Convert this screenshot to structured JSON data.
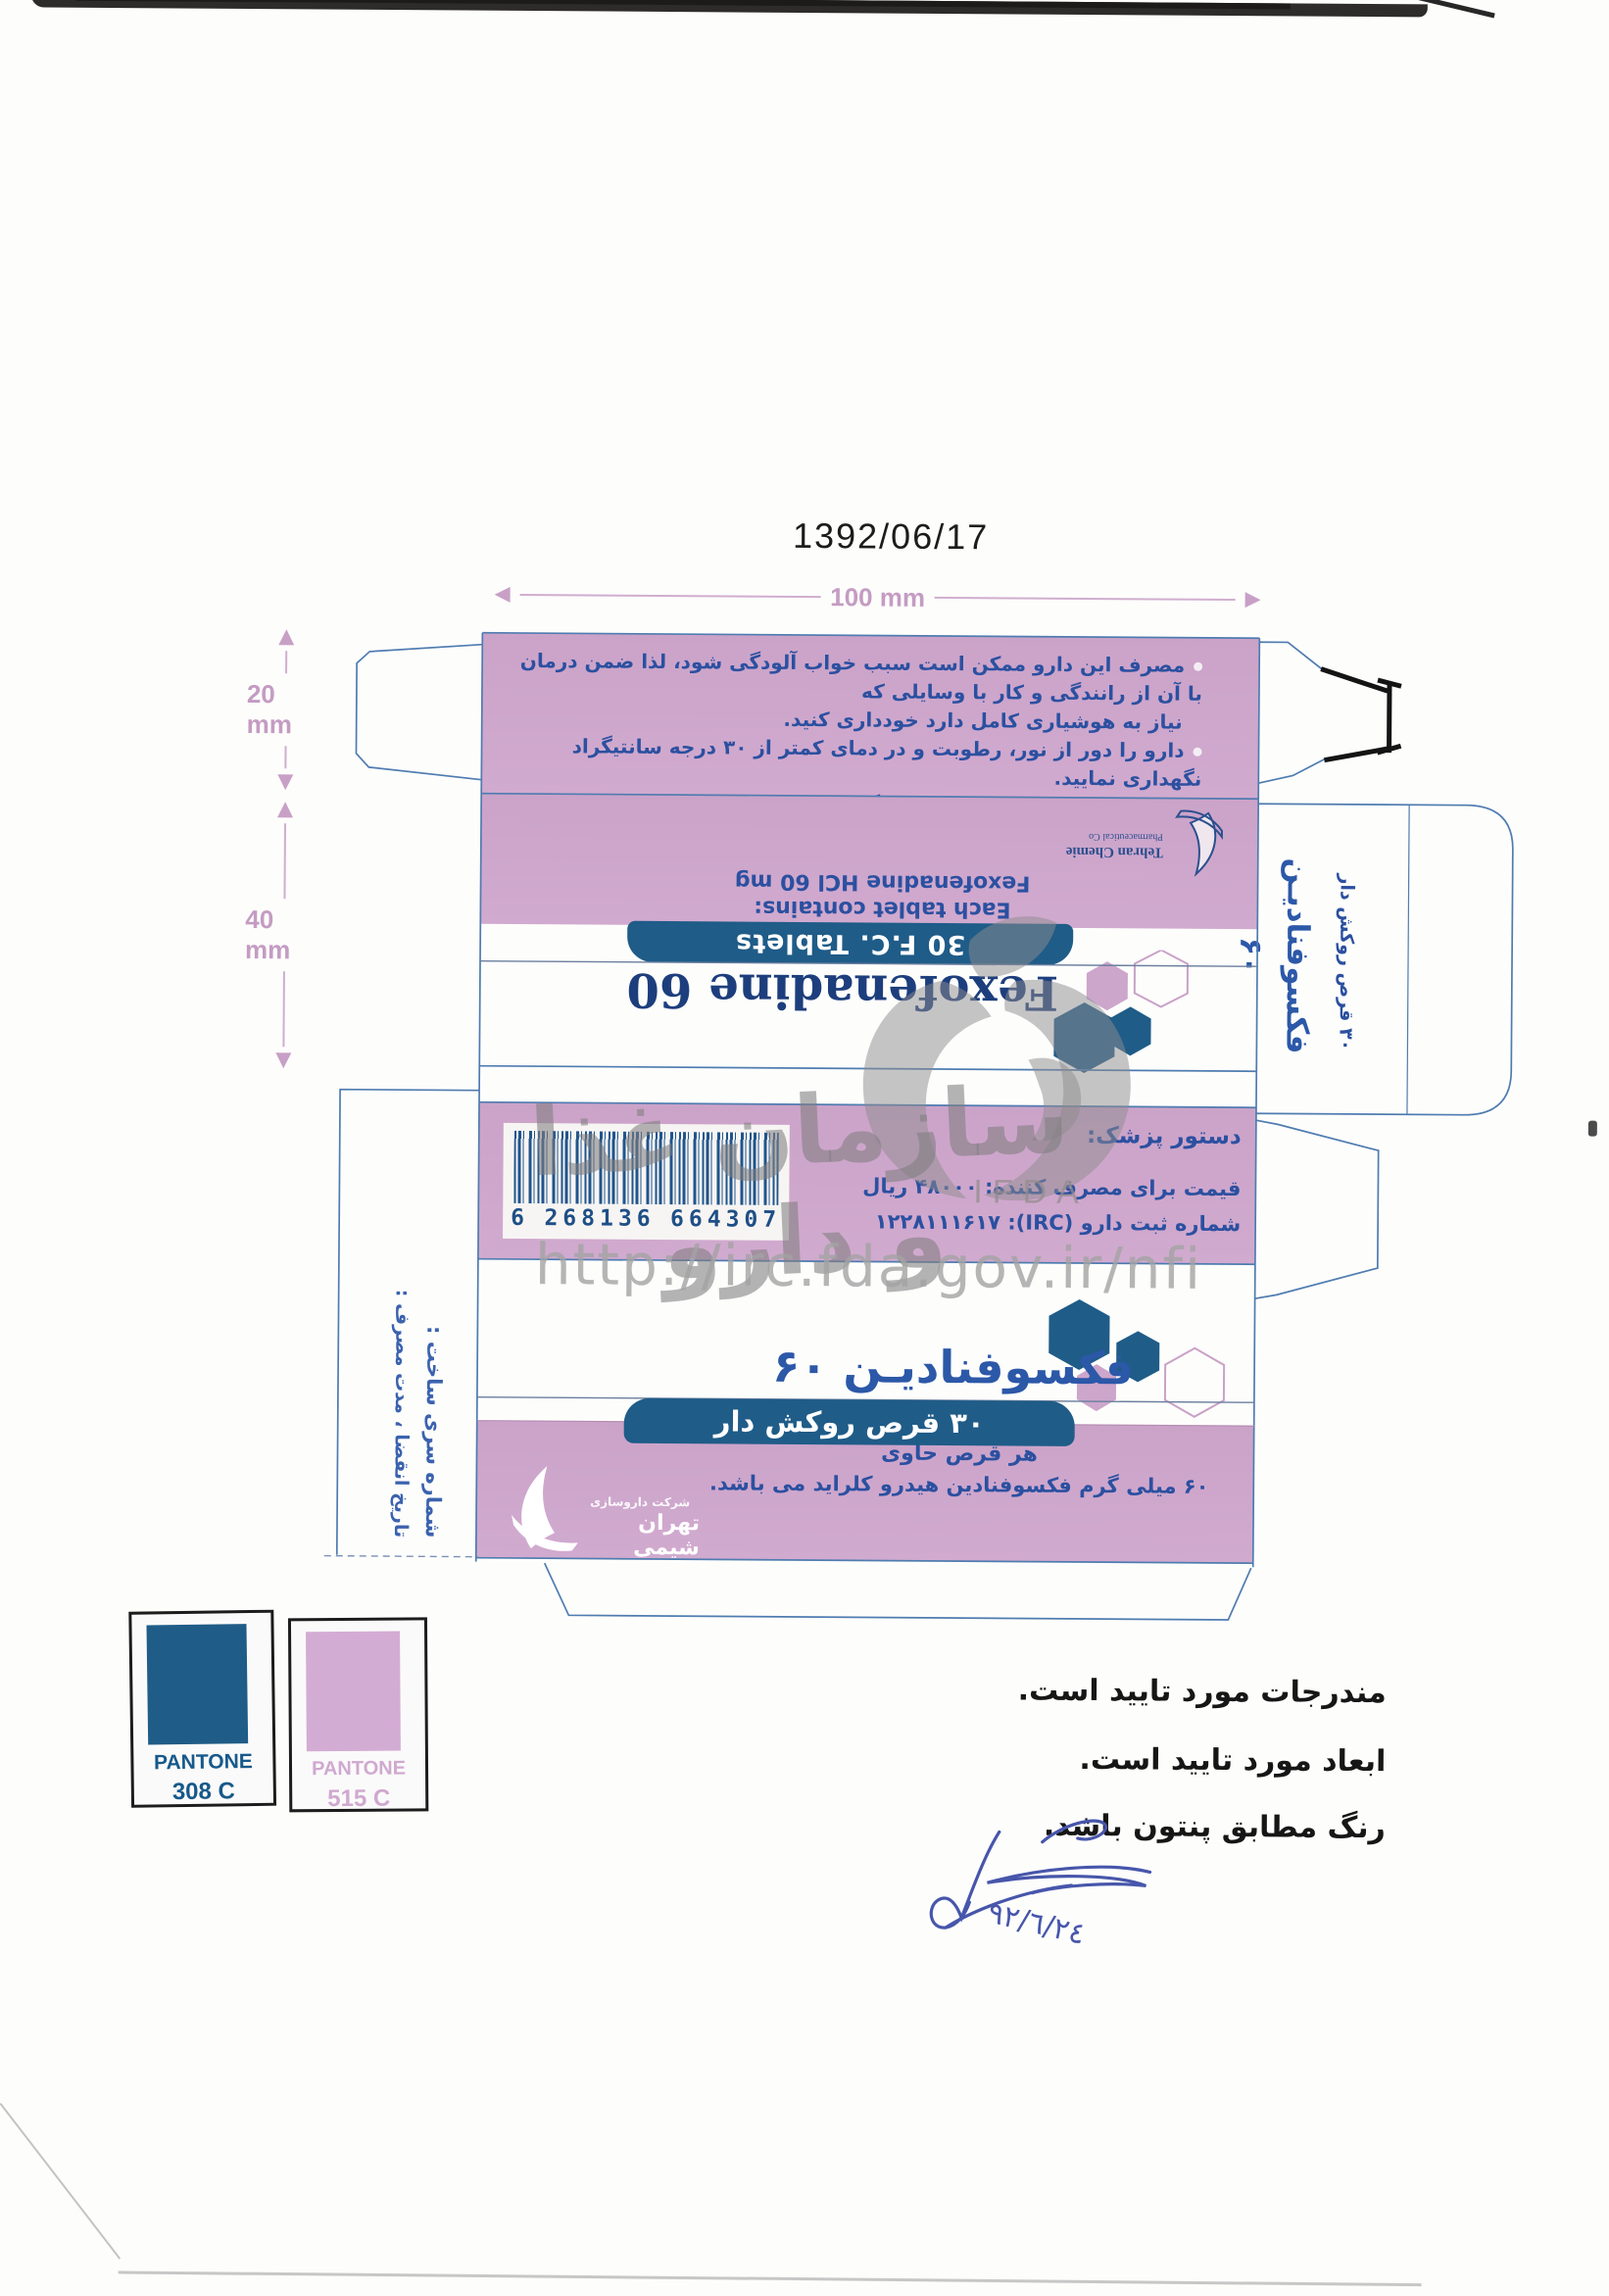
{
  "meta": {
    "proof_date": "1392/06/17"
  },
  "dimensions": {
    "width_label": "100 mm",
    "flap_label": "20 mm",
    "panel_label": "40 mm"
  },
  "warnings": {
    "b1a": "مصرف این دارو ممکن است سبب خواب آلودگی شود، لذا ضمن درمان با آن از رانندگی و کار با وسایلی که",
    "b1b": "نیاز به هوشیاری کامل دارد خودداری کنید.",
    "b2": "دارو را دور از نور، رطوبت و در دمای کمتر از ۳۰ درجه سانتیگراد نگهداری نمایید.",
    "b3": "دارو را دور از دسترس کودکان نگهداری نمایید.",
    "b4": "فروش بدون نسخه پزشک ممنوع است."
  },
  "back_panel": {
    "company_line1": "Tehran Chemie",
    "company_line2": "Pharmaceutical Co",
    "contains_line1": "Each tablet contains:",
    "contains_line2": "Fexofenadine HCl 60 mg",
    "tablets_bar": "30 F.C. Tablets",
    "brand": "Fexofenadine 60"
  },
  "barcode_panel": {
    "digits_1": "6",
    "digits_2": "268136",
    "digits_3": "664307",
    "rx_label": "دستور پزشک:",
    "price_line": "قیمت برای مصرف کننده: ۴۸۰۰۰ ریال",
    "irc_line": "شماره ثبت دارو (IRC): ۱۲۲۸۱۱۱۶۱۷"
  },
  "front_panel": {
    "brand": "فکسوفنادیـن ۶۰",
    "tablets_bar": "۳۰ قرص روکش دار",
    "contains_line1": "هر قرص حاوی",
    "contains_line2": "۶۰ میلی گرم فکسوفنادین هیدرو کلراید می باشد.",
    "company_fa_small": "شرکت داروسازی",
    "company_fa_large": "تهران شیمی"
  },
  "end_flap": {
    "brand": "فکسوفنادیـن ۶۰",
    "subtitle": "۳۰ قرص روکش دار"
  },
  "spine": {
    "batch_label": "شماره سری ساخت :",
    "expiry_label": "تاریخ انقضا ، مدت مصرف :"
  },
  "pantone": {
    "chip1_name": "PANTONE",
    "chip1_code": "308 C",
    "chip1_hex": "#1e5c87",
    "chip2_name": "PANTONE",
    "chip2_code": "515 C",
    "chip2_hex": "#d2abd3"
  },
  "approval": {
    "line1": "مندرجات مورد تایید است.",
    "line2": "ابعاد مورد تایید است.",
    "line3": "رنگ مطابق پنتون باشد.",
    "handwritten_date": "٩٢/٦/٢٤"
  },
  "watermark": {
    "org_fa": "سازمان غذا و دارو",
    "org_en": "IFDA",
    "url": "http://irc.fda.gov.ir/nfi"
  },
  "colors": {
    "pantone_308c": "#1e5c87",
    "pantone_515c": "#d2abd3",
    "text_blue": "#2b50a0",
    "brand_navy": "#1d3e7d",
    "dieline_blue": "#4f7cb0"
  }
}
